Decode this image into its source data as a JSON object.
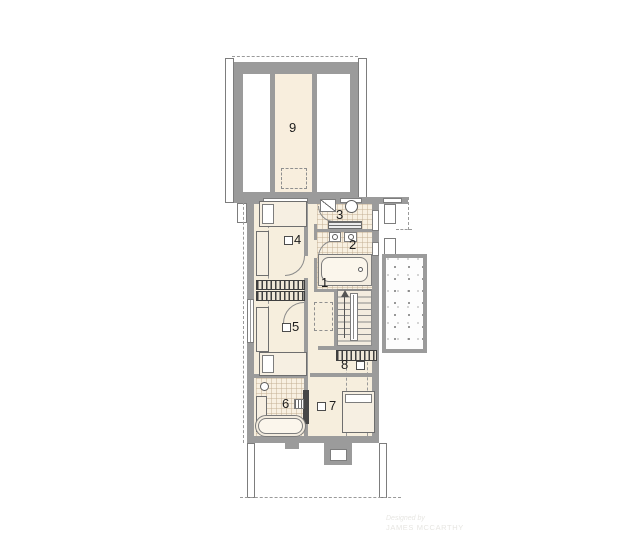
{
  "plan": {
    "room_labels": {
      "r1": "1",
      "r2": "2",
      "r3": "3",
      "r4": "4",
      "r5": "5",
      "r6": "6",
      "r7": "7",
      "r8": "8",
      "r9": "9"
    }
  },
  "watermark": {
    "line1": "Designed by",
    "line2": "JAMES MCCARTHY"
  },
  "colors": {
    "paper": "#ffffff",
    "wall": "#9b9b9b",
    "wall_dark": "#7d7d7d",
    "floor": "#f6eedd",
    "terrace_strip": "#f8eedd",
    "hatch": "#3f3f3f",
    "dash": "#9a9a9a",
    "label": "#1c1c1c",
    "watermark_text": "#e7e6e2"
  }
}
